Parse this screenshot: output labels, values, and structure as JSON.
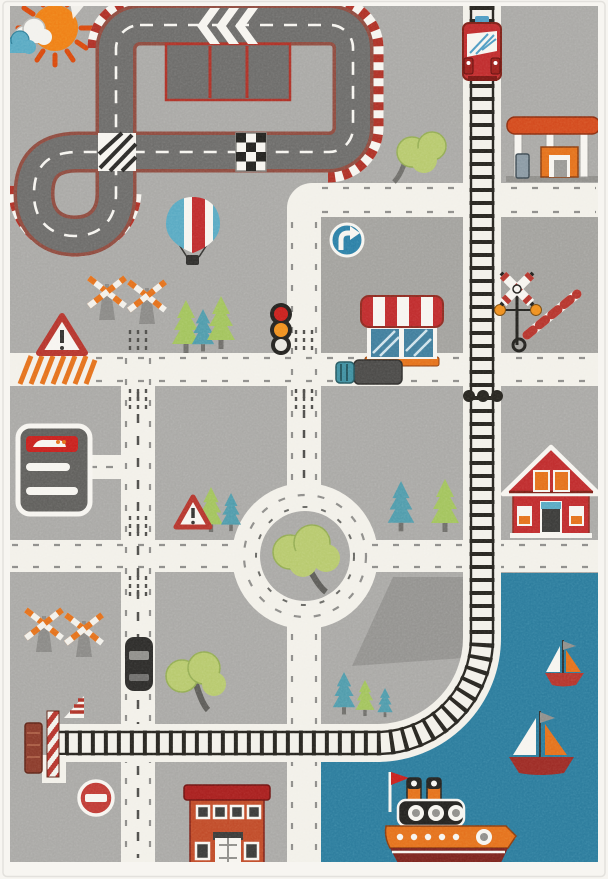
{
  "image": {
    "type": "product-photo",
    "subject": "children's city road play rug seen from above",
    "background": "white"
  },
  "palette": {
    "page": "#ffffff",
    "fringe": "#f7f5f1",
    "field": "#a9a8a5",
    "block": "#9c9b98",
    "road": "#f2f0e9",
    "tick": "#8d8c89",
    "dash-dark": "#4e4d4a",
    "asphalt": "#6c6b69",
    "track-edge": "#8e4a3e",
    "curb-red": "#ae3026",
    "white": "#f6f4ef",
    "ink": "#23221f",
    "rail": "#26241f",
    "water": "#2b7b9c",
    "tree-green": "#b7c96d",
    "tree-edge": "#93ac52",
    "pine-green": "#a2c35c",
    "pine-teal": "#4f9bab",
    "trunk": "#6e6d69",
    "red": "#bf2b2c",
    "dark-red": "#7d2018",
    "orange": "#e4701c",
    "sun": "#ef7f16",
    "sun-ray": "#d9480f",
    "cloud-teal": "#58a9c2",
    "sign-blue": "#2b7fa6",
    "steel": "#8a99a3"
  },
  "labels": {
    "rug": "kids road play rug",
    "racetrack": "race track loop with chevrons, pit lane, checkered crossing",
    "railway": "railway line crossing the rug",
    "train": "red commuter train",
    "gas_station": "gas station with orange canopy",
    "balloon": "hot air balloon",
    "shop": "shop with red and white awning",
    "roundabout": "roundabout with tree island",
    "house": "red house",
    "harbor": "harbor water with boats",
    "steamboat": "red and orange steamboat",
    "fire_building": "brick building",
    "carwash": "car wash building",
    "sun": "sun and clouds"
  },
  "scene": {
    "rug_elements": [
      {
        "name": "sun-and-clouds",
        "location": "top-left"
      },
      {
        "name": "race-track-loop",
        "location": "top-left quadrant"
      },
      {
        "name": "pit-lane",
        "location": "inside race track"
      },
      {
        "name": "chevron-markings",
        "location": "race track top straight"
      },
      {
        "name": "checkered-crossing",
        "location": "race track lower straight"
      },
      {
        "name": "hatched-crossing",
        "location": "race track self-crossing"
      },
      {
        "name": "hot-air-balloon",
        "location": "upper middle-left"
      },
      {
        "name": "railway-line",
        "location": "top to bottom-left with curve"
      },
      {
        "name": "red-train",
        "location": "top of railway"
      },
      {
        "name": "gas-station",
        "location": "top-right"
      },
      {
        "name": "turn-right-sign",
        "location": "center block"
      },
      {
        "name": "awning-shop",
        "location": "center block"
      },
      {
        "name": "railroad-crossing-signal",
        "location": "center right of railway"
      },
      {
        "name": "traffic-light",
        "location": "left of center block"
      },
      {
        "name": "crossing-barriers",
        "location": "middle-left and lower-left"
      },
      {
        "name": "warning-triangle-signs",
        "location": "left and near roundabout"
      },
      {
        "name": "pine-trees",
        "location": "scattered"
      },
      {
        "name": "round-trees",
        "location": "scattered"
      },
      {
        "name": "roundabout",
        "location": "center"
      },
      {
        "name": "red-house",
        "location": "middle-right"
      },
      {
        "name": "car-wash-building",
        "location": "middle-left"
      },
      {
        "name": "delivery-truck",
        "location": "main road below shop"
      },
      {
        "name": "black-car",
        "location": "left vertical road"
      },
      {
        "name": "orange-hatched-crosswalk",
        "location": "left end of main road"
      },
      {
        "name": "no-entry-sign",
        "location": "bottom-left"
      },
      {
        "name": "dock-with-barge",
        "location": "left end of railway"
      },
      {
        "name": "brick-building",
        "location": "bottom-center"
      },
      {
        "name": "harbor-water",
        "location": "bottom-right"
      },
      {
        "name": "small-sailboat",
        "location": "harbor"
      },
      {
        "name": "large-sailboat",
        "location": "harbor"
      },
      {
        "name": "steamboat",
        "location": "harbor bottom"
      }
    ]
  }
}
